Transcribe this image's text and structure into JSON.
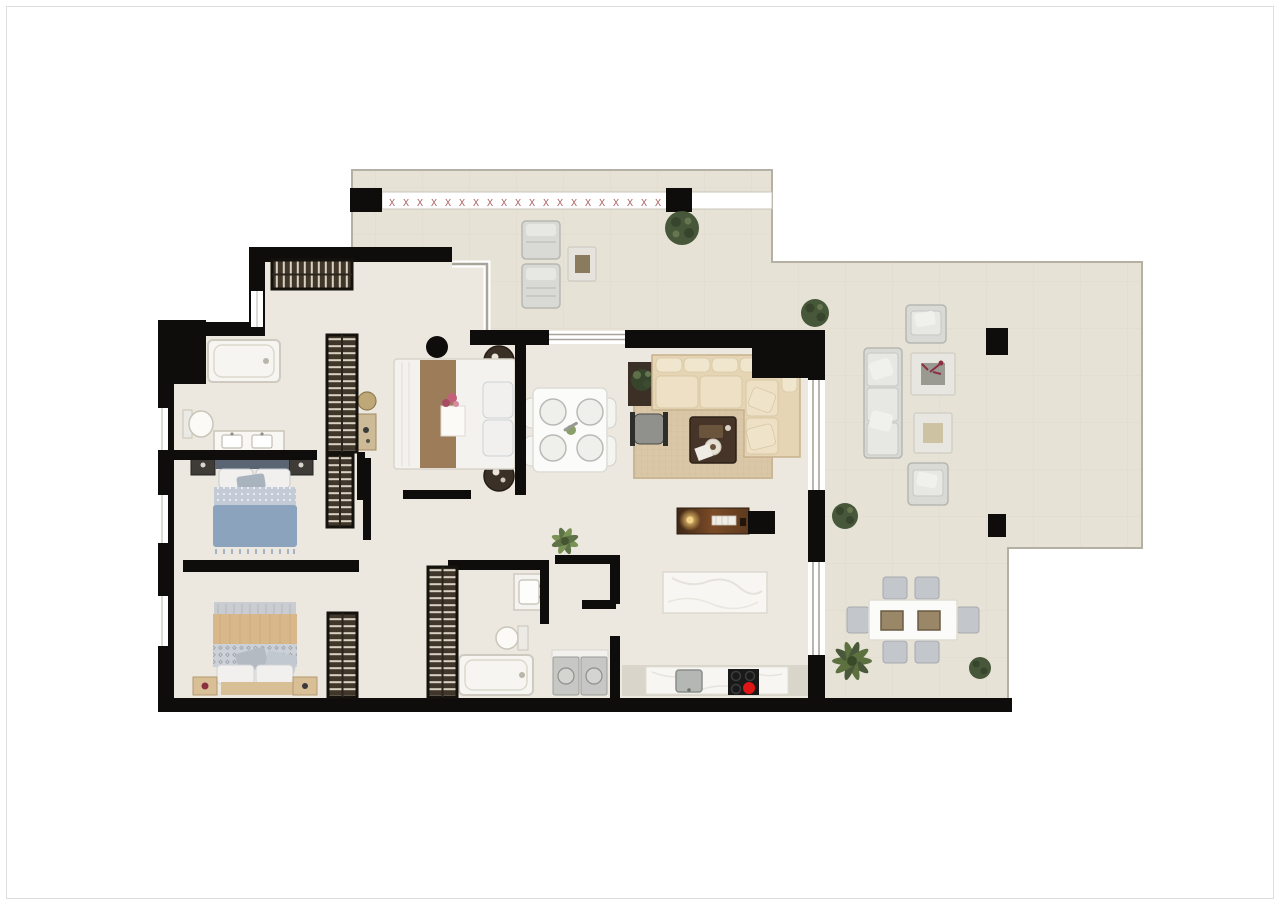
{
  "meta": {
    "type": "apartment-floor-plan",
    "description": "Top-down rendered floor plan: three bedrooms, two bathrooms, open kitchen / living-dining room, entry hall, laundry closet and wrap-around terraces with outdoor lounge and dining furniture",
    "visible_text": "none"
  },
  "colors": {
    "wall": "#0e0d0b",
    "floorIndoor": "#ece8df",
    "floorOutdoor": "#e7e2d6",
    "tileLine": "#ddd7c9",
    "terraceEdge": "#b5b0a4",
    "glass": "#a9a59b",
    "railingGlyph": "#b06565",
    "wardrobe": "#41362a",
    "wardrobeRung": "#d9d2c2",
    "sofaBase": "#e5d5b5",
    "sofaCushion": "#ede0c4",
    "sofaStroke": "#c7b28b",
    "rug": "#d9c7a7",
    "rugLine": "#c9b795",
    "woodDark": "#453427",
    "gold": "#e3b963",
    "bedBlueDuvet": "#8ba3bd",
    "bedBlueKnit": "#c3ccd6",
    "bedBlueHead": "#5a6472",
    "bedTanDuvet": "#d8b88a",
    "bedTanWood": "#d9bf96",
    "bandGray": "#ccd1d7",
    "pillowWhite": "#f1f0ee",
    "bedWhite": "#f3f2ee",
    "runnerBrown": "#9d7c5a",
    "nightRound": "#3a3026",
    "outdoorGray": "#d9d9d5",
    "outdoorGrayDark": "#b7b7b2",
    "outdoorCushion": "#e7e7e3",
    "chairGray": "#c3c6ca",
    "tableWhite": "#fbfbf9",
    "marble": "#f7f6f2",
    "sinkGray": "#b4b7b4",
    "hobBlack": "#191919",
    "burnerRed": "#e01515",
    "bushGreen": "#47573a",
    "bushDark": "#36452c",
    "palmGreen": "#5d7040",
    "plantLight": "#7a9355",
    "fixtureStroke": "#cfcac0",
    "applianceGray": "#c7c7c5",
    "redPlant": "#8a3040",
    "blackDecor": "#141414"
  },
  "railing": {
    "glyph": "X",
    "count": 20,
    "start_x": 392,
    "step": 14,
    "y": 206
  },
  "counts": {
    "bedrooms": 3,
    "bathrooms": 2,
    "wardrobes": 5,
    "sun_loungers": 2,
    "terrace_dining_chairs": 6,
    "indoor_dining_place_settings": 4,
    "hob_burners": 4,
    "active_burners": 1,
    "terrace_pillars": 4,
    "bushes": 5
  },
  "rooms": [
    {
      "name": "entry-hall"
    },
    {
      "name": "corridor"
    },
    {
      "name": "bathroom-1"
    },
    {
      "name": "bedroom-1-blue"
    },
    {
      "name": "bedroom-2-tan"
    },
    {
      "name": "bedroom-3-center"
    },
    {
      "name": "bathroom-2"
    },
    {
      "name": "laundry-closet"
    },
    {
      "name": "kitchen"
    },
    {
      "name": "living-dining-room"
    },
    {
      "name": "top-terrace"
    },
    {
      "name": "main-terrace"
    },
    {
      "name": "terrace-dining-area"
    }
  ],
  "inventory": [
    "bathtub",
    "toilet",
    "double-vanity",
    "single-sink",
    "shower-tub",
    "bed-blue",
    "bed-tan",
    "bed-white-runner",
    "round-nightstands",
    "l-shaped-sofa",
    "area-rug",
    "coffee-table",
    "accent-chair",
    "sideboard-console",
    "dining-table-4-seats",
    "kitchen-island",
    "kitchen-counter-sink-hob",
    "washer-dryer-pair",
    "desk-and-chair",
    "sun-loungers",
    "outdoor-sofa",
    "outdoor-armchairs",
    "outdoor-coffee-tables",
    "outdoor-dining-table-6-chairs",
    "potted-bushes",
    "palm-plant",
    "indoor-plants"
  ]
}
